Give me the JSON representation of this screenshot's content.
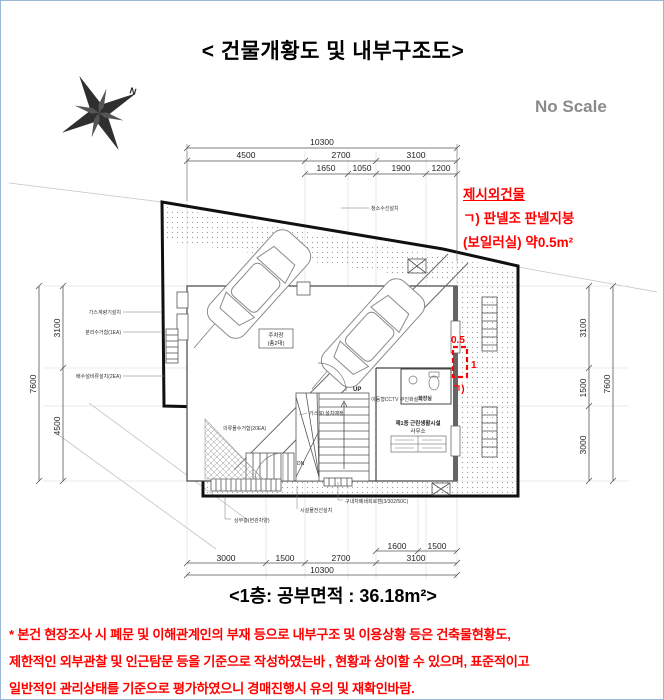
{
  "header": {
    "title": "< 건물개황도 및 내부구조도>",
    "scale_note": "No Scale",
    "compass_n": "N"
  },
  "annotation": {
    "title": "제시외건물",
    "line1": "ㄱ) 판넬조 판넬지붕",
    "line2": "(보일러실) 약0.5m²"
  },
  "dims": {
    "top": {
      "total": "10300",
      "row2": [
        "4500",
        "2700",
        "3100"
      ],
      "row3": [
        "1650",
        "1050",
        "1900",
        "1200"
      ]
    },
    "left": {
      "total": "7600",
      "parts": [
        "3100",
        "4500"
      ]
    },
    "right": {
      "total": "7600",
      "parts": [
        "3100",
        "1500",
        "3000"
      ]
    },
    "bottom": {
      "row1": [
        "1600",
        "1500"
      ],
      "row2": [
        "3000",
        "1500",
        "2700",
        "3100"
      ],
      "total": "10300"
    }
  },
  "plan": {
    "parking_line1": "주차장",
    "parking_line2": "(총2대)",
    "bathroom_label": "화장실",
    "office_line1": "제1종 근린생활시설",
    "office_line2": "사무소",
    "up": "UP",
    "dn": "DN",
    "red_area": "0.5",
    "red_len": "1",
    "red_key": "ㄱ)",
    "leaders": {
      "top": "청소수선설치",
      "gas": "가스계량기설치",
      "recycle": "분리수거함(1EA)",
      "drain": "배수설비류설치(2EA)",
      "cctv": "이동형CCTV 무인화설치",
      "gas30": "가스30 설치예정",
      "sort": "의류물수거함(20EA)",
      "canopy": "상부층(현관차양)",
      "wire": "시설물전선설치",
      "cam": "구내차폐쇄회로캠(3/302/50C)"
    }
  },
  "caption": "<1층: 공부면적 : 36.18m²>",
  "disclaimer": {
    "line1": "* 본건 현장조사 시 폐문 및 이해관계인의 부재 등으로  내부구조 및 이용상황 등은  건축물현황도,",
    "line2": "제한적인 외부관찰 및 인근탐문 등을 기준으로 작성하였는바 , 현황과 상이할 수 있으며, 표준적이고",
    "line3": "일반적인 관리상태를 기준으로 평가하였으니 경매진행시 유의 및 재확인바람."
  },
  "colors": {
    "accent_red": "#ff0000",
    "note_gray": "#8a8a8a"
  }
}
